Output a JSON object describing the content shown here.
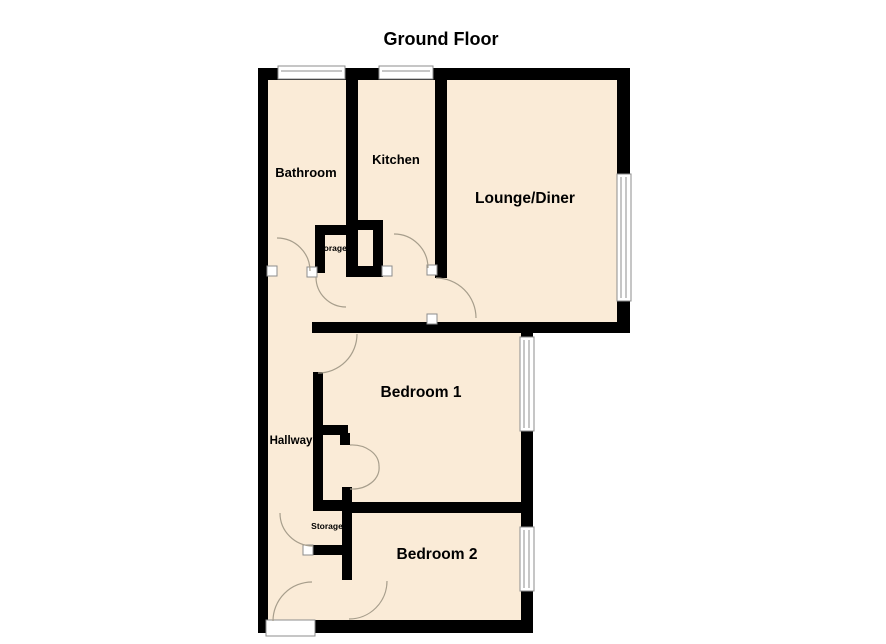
{
  "title": "Ground Floor",
  "colors": {
    "background": "#FFFFFF",
    "floor_fill": "#FAEBD7",
    "wall": "#000000",
    "door_arc": "#A79E8C",
    "window_frame": "#8C8C8C",
    "text": "#000000"
  },
  "rooms": {
    "bathroom": {
      "label": "Bathroom"
    },
    "kitchen": {
      "label": "Kitchen"
    },
    "lounge_diner": {
      "label": "Lounge/Diner"
    },
    "bedroom1": {
      "label": "Bedroom 1"
    },
    "hallway": {
      "label": "Hallway"
    },
    "bedroom2": {
      "label": "Bedroom 2"
    },
    "storage_upper": {
      "label": "Storage"
    },
    "storage_lower": {
      "label": "Storage"
    }
  }
}
